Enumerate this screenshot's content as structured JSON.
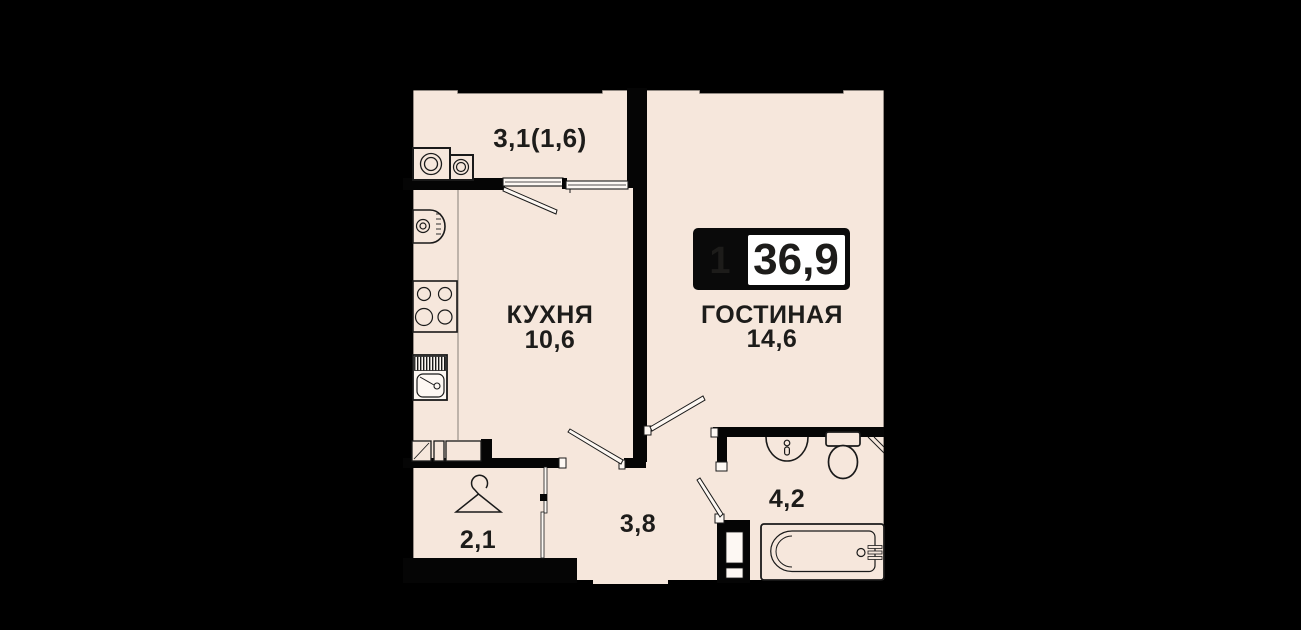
{
  "apartment": {
    "badge": {
      "rooms": "1",
      "total_area": "36,9"
    },
    "rooms": {
      "balcony": {
        "area": "3,1(1,6)"
      },
      "kitchen": {
        "label": "КУХНЯ",
        "area": "10,6"
      },
      "living": {
        "label": "ГОСТИНАЯ",
        "area": "14,6"
      },
      "hall": {
        "area": "3,8"
      },
      "wardrobe": {
        "area": "2,1"
      },
      "bathroom": {
        "area": "4,2"
      }
    },
    "colors": {
      "background": "#000000",
      "floor": "#f6e7dc",
      "wall": "#050505",
      "line": "#1a1a1a",
      "text": "#1d1c1a",
      "badge_bg": "#0a0a0a",
      "badge_panel": "#ffffff"
    }
  }
}
